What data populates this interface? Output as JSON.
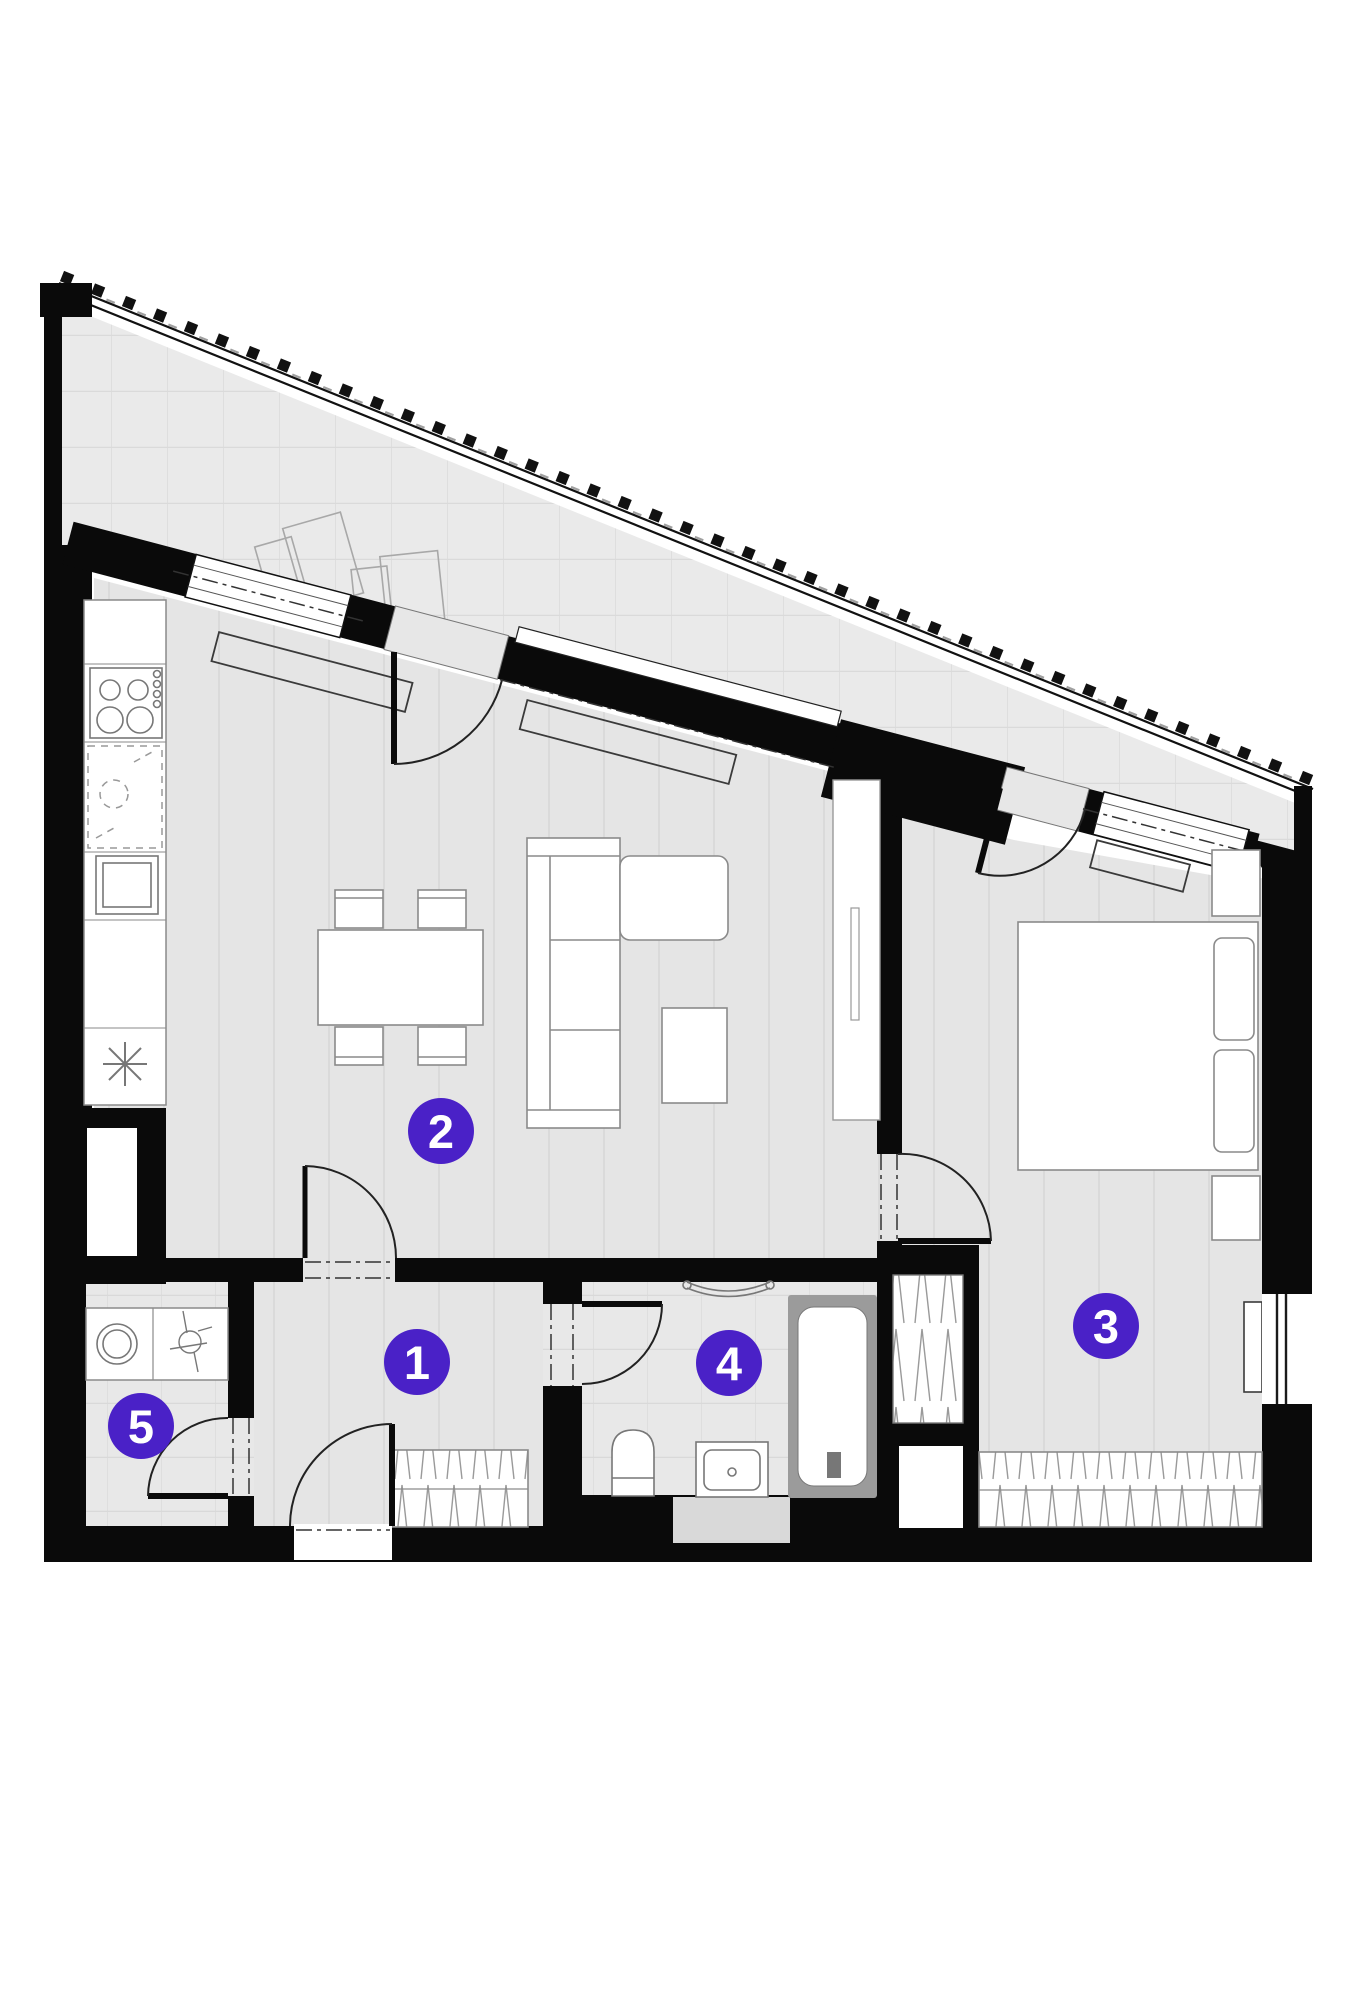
{
  "plan": {
    "type": "apartment-floor-plan",
    "badges": [
      {
        "label": "1"
      },
      {
        "label": "2"
      },
      {
        "label": "3"
      },
      {
        "label": "4"
      },
      {
        "label": "5"
      }
    ],
    "colors": {
      "badge": "#4a21c7",
      "badge_text": "#ffffff",
      "wall": "#0a0a0a",
      "floor": "#e5e5e5",
      "tile_floor": "#e8e8e8",
      "balcony_floor": "#eaeaea",
      "fixture_fill": "#ffffff",
      "fixture_stroke": "#828282",
      "tub_surround": "#9b9b9b"
    }
  }
}
